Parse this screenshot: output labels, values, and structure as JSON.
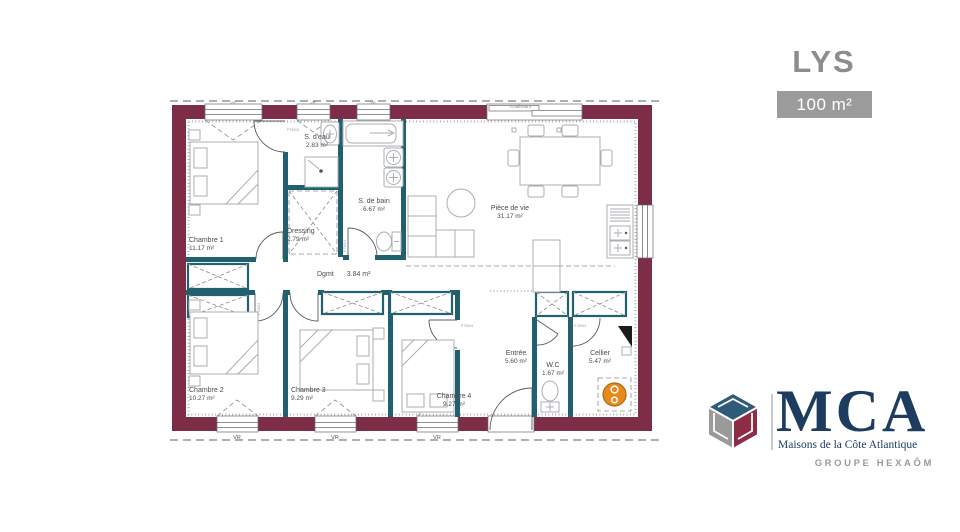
{
  "title": "LYS",
  "area_badge": "100 m²",
  "plan": {
    "rooms": [
      {
        "name": "Chambre 1",
        "area": "11.17 m²"
      },
      {
        "name": "S. d'eau",
        "area": "2.83 m²"
      },
      {
        "name": "S. de bain",
        "area": "6.67 m²"
      },
      {
        "name": "Dressing",
        "area": "2.79 m²"
      },
      {
        "name": "Pièce de vie",
        "area": "31.17 m²"
      },
      {
        "name": "Dgmt",
        "area": "3.84 m²"
      },
      {
        "name": "Chambre 2",
        "area": "10.27 m²"
      },
      {
        "name": "Chambre 3",
        "area": "9.29 m²"
      },
      {
        "name": "Chambre 4",
        "area": "9.27 m²"
      },
      {
        "name": "Entrée",
        "area": "5.60 m²"
      },
      {
        "name": "W.C",
        "area": "1.67 m²"
      },
      {
        "name": "Cellier",
        "area": "5.47 m²"
      }
    ],
    "window_label_vr": "VR",
    "sliding_bay_label": "Coulissant",
    "door_ref": "P73004"
  },
  "logo": {
    "acronym": "MCA",
    "subtitle": "Maisons de la Côte Atlantique",
    "group": "GROUPE HEXAÔM"
  },
  "colors": {
    "exterior_wall": "#7e2d46",
    "interior_wall": "#20606f",
    "water_heater": "#e8891d",
    "logo_navy": "#1d3c60",
    "logo_red": "#8e2b45",
    "logo_blue": "#2e5c78",
    "logo_gray": "#9a9a9a",
    "title_gray": "#8d8d8d",
    "badge_bg": "#9b9b9b"
  }
}
